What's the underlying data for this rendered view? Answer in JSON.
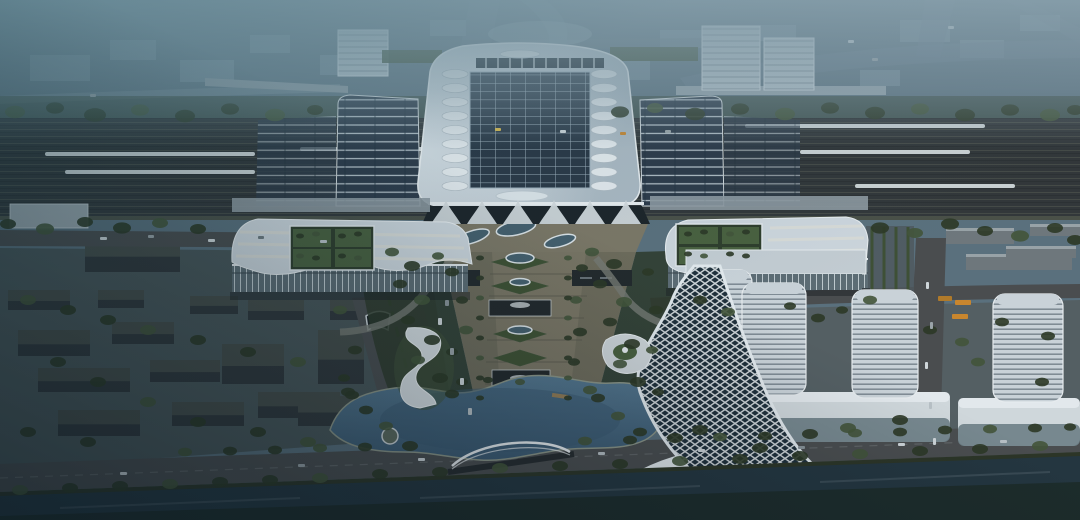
{
  "meta": {
    "title": "Aerial rendering of high-speed railway station complex at dusk",
    "description": "Bird's-eye architectural rendering: central station hall with solar roof and skylights, platform canopies over railway tracks with trains, twin wave-roof wing buildings with rooftop gardens, axial garden plaza leading to a lake with an arch bridge, a twisted lattice landmark tower, striped office towers on podiums, dark city blocks, boulevards with cars and buses, and a canal in the foreground"
  },
  "palette": {
    "base": "#5a707d",
    "sky_haze": "#8fa5b1",
    "distant_block": "#8299a6",
    "railway": "#32373a",
    "track_line": "#474c48",
    "train": "#d6dde0",
    "canopy_panel": "#2e3b4a",
    "canopy_rib": "#b6c1c9",
    "hall_roof": "#c6d0d8",
    "hall_edge": "#e7ecef",
    "solar": "#2b3947",
    "solar_frame": "#9fb0bc",
    "skylight": "#e2e8ec",
    "facade_glass": "#1d2429",
    "arch": "#d3dade",
    "wing_roof": "#ccd5dc",
    "wing_stripe": "#e6e2d2",
    "courtyard": "#2f3d2c",
    "courtyard_lawn": "#49603f",
    "wing_facade": "#5d6c74",
    "tree": "#2c3826",
    "tree_light": "#42543a",
    "lawn": "#3f5133",
    "plaza": "#6e6b5b",
    "walk": "#7c7766",
    "stair": "#5a584c",
    "road": "#4a4d4f",
    "lane": "#707476",
    "lake": "#4c6e86",
    "lake_deep": "#3a5870",
    "shore": "#8b9588",
    "canal": "#243640",
    "embankment": "#2c3527",
    "block_top": "#454c49",
    "block_side": "#30363a",
    "tower": "#c9d2d8",
    "tower_stripe": "#7c8891",
    "podium": "#cfd7db",
    "podium_glass": "#6d7f86",
    "twist": "#e2e9ed",
    "twist_glass": "#20303b",
    "bus": "#c8862e",
    "dome": "#8fa5b0",
    "overlay_teal": "#14505f",
    "vignette": "#0a1822"
  },
  "scene": {
    "station": {
      "skylight_columns": 2,
      "skylights_per_column": 9,
      "skylight_col_x": [
        455,
        604
      ],
      "skylight_y0": 74,
      "skylight_step": 14
    },
    "landmarks": [
      "main-station-hall",
      "solar-roof",
      "platform-canopies",
      "railway-tracks",
      "west-wing",
      "east-wing",
      "roof-gardens",
      "axial-garden-plaza",
      "lake",
      "arch-bridge",
      "canal",
      "twisted-tower",
      "office-towers",
      "retail-podiums",
      "city-blocks",
      "boulevard",
      "tunnel-portal"
    ],
    "trains": [
      [
        45,
        152,
        210
      ],
      [
        65,
        170,
        190
      ],
      [
        300,
        147,
        160
      ],
      [
        745,
        124,
        240
      ],
      [
        800,
        150,
        170
      ],
      [
        855,
        184,
        160
      ]
    ],
    "towers": [
      [
        706,
        270,
        46,
        95
      ],
      [
        742,
        283,
        64,
        112
      ],
      [
        852,
        290,
        66,
        108
      ],
      [
        993,
        294,
        70,
        108
      ]
    ],
    "barracks": [
      [
        946,
        228,
        68,
        16
      ],
      [
        966,
        254,
        106,
        16
      ],
      [
        1030,
        224,
        50,
        12
      ],
      [
        1006,
        246,
        70,
        12
      ]
    ],
    "west_blocks": [
      [
        18,
        330,
        72,
        26
      ],
      [
        112,
        322,
        62,
        22
      ],
      [
        38,
        368,
        92,
        24
      ],
      [
        150,
        360,
        70,
        22
      ],
      [
        222,
        344,
        62,
        40
      ],
      [
        258,
        392,
        82,
        26
      ],
      [
        172,
        402,
        72,
        24
      ],
      [
        58,
        410,
        82,
        26
      ],
      [
        248,
        300,
        56,
        20
      ],
      [
        318,
        330,
        46,
        54
      ],
      [
        298,
        396,
        62,
        30
      ],
      [
        8,
        290,
        62,
        20
      ],
      [
        98,
        290,
        46,
        18
      ],
      [
        330,
        300,
        42,
        20
      ],
      [
        85,
        238,
        95,
        34
      ],
      [
        190,
        296,
        48,
        18
      ]
    ],
    "trees": [
      [
        15,
        112,
        10
      ],
      [
        55,
        108,
        9
      ],
      [
        95,
        115,
        11
      ],
      [
        140,
        110,
        9
      ],
      [
        185,
        116,
        10
      ],
      [
        230,
        109,
        9
      ],
      [
        275,
        115,
        10
      ],
      [
        315,
        110,
        8
      ],
      [
        620,
        112,
        9
      ],
      [
        655,
        108,
        8
      ],
      [
        695,
        114,
        10
      ],
      [
        740,
        109,
        9
      ],
      [
        785,
        114,
        10
      ],
      [
        830,
        108,
        9
      ],
      [
        875,
        113,
        10
      ],
      [
        920,
        109,
        9
      ],
      [
        965,
        115,
        10
      ],
      [
        1010,
        110,
        9
      ],
      [
        1050,
        115,
        10
      ],
      [
        1075,
        110,
        8
      ],
      [
        8,
        224,
        8
      ],
      [
        45,
        229,
        9
      ],
      [
        85,
        222,
        8
      ],
      [
        122,
        228,
        9
      ],
      [
        160,
        223,
        8
      ],
      [
        198,
        229,
        8
      ],
      [
        880,
        228,
        9
      ],
      [
        915,
        233,
        8
      ],
      [
        950,
        224,
        9
      ],
      [
        985,
        231,
        8
      ],
      [
        1020,
        236,
        9
      ],
      [
        1055,
        228,
        8
      ],
      [
        1075,
        240,
        8
      ],
      [
        392,
        252,
        7
      ],
      [
        412,
        266,
        8
      ],
      [
        400,
        284,
        7
      ],
      [
        422,
        300,
        8
      ],
      [
        408,
        320,
        7
      ],
      [
        432,
        340,
        8
      ],
      [
        418,
        360,
        7
      ],
      [
        440,
        378,
        8
      ],
      [
        452,
        394,
        7
      ],
      [
        438,
        256,
        6
      ],
      [
        452,
        272,
        7
      ],
      [
        462,
        300,
        6
      ],
      [
        466,
        330,
        7
      ],
      [
        452,
        352,
        6
      ],
      [
        462,
        382,
        6
      ],
      [
        592,
        252,
        7
      ],
      [
        614,
        264,
        8
      ],
      [
        600,
        284,
        7
      ],
      [
        624,
        302,
        8
      ],
      [
        610,
        322,
        7
      ],
      [
        632,
        344,
        8
      ],
      [
        620,
        364,
        7
      ],
      [
        638,
        382,
        8
      ],
      [
        582,
        268,
        6
      ],
      [
        576,
        300,
        6
      ],
      [
        580,
        332,
        7
      ],
      [
        574,
        362,
        6
      ],
      [
        590,
        390,
        7
      ],
      [
        648,
        272,
        6
      ],
      [
        656,
        310,
        7
      ],
      [
        652,
        350,
        6
      ],
      [
        480,
        258,
        4
      ],
      [
        480,
        278,
        4
      ],
      [
        480,
        298,
        4
      ],
      [
        480,
        318,
        4
      ],
      [
        480,
        338,
        4
      ],
      [
        480,
        358,
        4
      ],
      [
        480,
        378,
        4
      ],
      [
        480,
        398,
        4
      ],
      [
        568,
        258,
        4
      ],
      [
        568,
        278,
        4
      ],
      [
        568,
        298,
        4
      ],
      [
        568,
        318,
        4
      ],
      [
        568,
        338,
        4
      ],
      [
        568,
        358,
        4
      ],
      [
        568,
        378,
        4
      ],
      [
        568,
        398,
        4
      ],
      [
        300,
        236,
        4
      ],
      [
        316,
        234,
        4
      ],
      [
        342,
        236,
        4
      ],
      [
        358,
        234,
        4
      ],
      [
        300,
        256,
        4
      ],
      [
        316,
        258,
        4
      ],
      [
        342,
        256,
        4
      ],
      [
        358,
        258,
        4
      ],
      [
        688,
        234,
        4
      ],
      [
        704,
        232,
        4
      ],
      [
        730,
        234,
        4
      ],
      [
        746,
        232,
        4
      ],
      [
        688,
        254,
        4
      ],
      [
        704,
        256,
        4
      ],
      [
        730,
        254,
        4
      ],
      [
        746,
        256,
        4
      ],
      [
        185,
        452,
        7
      ],
      [
        230,
        451,
        7
      ],
      [
        275,
        450,
        7
      ],
      [
        320,
        448,
        7
      ],
      [
        365,
        447,
        7
      ],
      [
        410,
        446,
        8
      ],
      [
        585,
        441,
        7
      ],
      [
        630,
        440,
        7
      ],
      [
        675,
        438,
        8
      ],
      [
        720,
        437,
        7
      ],
      [
        765,
        436,
        7
      ],
      [
        810,
        434,
        8
      ],
      [
        855,
        433,
        7
      ],
      [
        900,
        432,
        7
      ],
      [
        945,
        430,
        7
      ],
      [
        990,
        429,
        7
      ],
      [
        1035,
        428,
        7
      ],
      [
        1070,
        427,
        6
      ],
      [
        20,
        490,
        8
      ],
      [
        70,
        488,
        8
      ],
      [
        120,
        486,
        8
      ],
      [
        170,
        484,
        8
      ],
      [
        220,
        482,
        8
      ],
      [
        270,
        480,
        8
      ],
      [
        320,
        478,
        8
      ],
      [
        380,
        474,
        8
      ],
      [
        440,
        472,
        8
      ],
      [
        500,
        468,
        8
      ],
      [
        560,
        466,
        8
      ],
      [
        620,
        464,
        8
      ],
      [
        680,
        461,
        8
      ],
      [
        740,
        459,
        8
      ],
      [
        800,
        456,
        8
      ],
      [
        860,
        454,
        8
      ],
      [
        920,
        451,
        8
      ],
      [
        980,
        449,
        8
      ],
      [
        1040,
        446,
        8
      ],
      [
        348,
        392,
        7
      ],
      [
        366,
        410,
        7
      ],
      [
        386,
        426,
        7
      ],
      [
        344,
        378,
        6
      ],
      [
        598,
        398,
        7
      ],
      [
        618,
        416,
        7
      ],
      [
        640,
        432,
        7
      ],
      [
        658,
        392,
        6
      ],
      [
        520,
        382,
        5
      ],
      [
        488,
        380,
        5
      ],
      [
        700,
        300,
        7
      ],
      [
        728,
        312,
        7
      ],
      [
        818,
        318,
        7
      ],
      [
        842,
        310,
        6
      ],
      [
        870,
        300,
        7
      ],
      [
        790,
        306,
        6
      ],
      [
        930,
        330,
        7
      ],
      [
        962,
        342,
        7
      ],
      [
        1002,
        322,
        7
      ],
      [
        1048,
        336,
        7
      ],
      [
        978,
        362,
        7
      ],
      [
        1042,
        382,
        7
      ],
      [
        900,
        420,
        8
      ],
      [
        848,
        428,
        8
      ],
      [
        700,
        430,
        8
      ],
      [
        760,
        448,
        8
      ],
      [
        28,
        300,
        8
      ],
      [
        68,
        310,
        8
      ],
      [
        108,
        320,
        8
      ],
      [
        148,
        330,
        8
      ],
      [
        198,
        340,
        8
      ],
      [
        248,
        352,
        8
      ],
      [
        298,
        362,
        8
      ],
      [
        58,
        362,
        8
      ],
      [
        98,
        382,
        8
      ],
      [
        148,
        402,
        8
      ],
      [
        198,
        422,
        8
      ],
      [
        258,
        432,
        8
      ],
      [
        308,
        442,
        8
      ],
      [
        28,
        432,
        8
      ],
      [
        88,
        442,
        8
      ],
      [
        340,
        310,
        7
      ],
      [
        355,
        350,
        7
      ],
      [
        352,
        395,
        7
      ]
    ],
    "vehicles": [
      [
        100,
        237,
        7,
        3,
        "#cfd6da"
      ],
      [
        148,
        235,
        6,
        3,
        "#9aa3a8"
      ],
      [
        208,
        239,
        7,
        3,
        "#cfd6da"
      ],
      [
        258,
        236,
        6,
        3,
        "#6e7a80"
      ],
      [
        320,
        240,
        7,
        3,
        "#b7c0c5"
      ],
      [
        438,
        318,
        4,
        7,
        "#cfd6da"
      ],
      [
        450,
        348,
        4,
        7,
        "#9aa3a8"
      ],
      [
        460,
        378,
        4,
        7,
        "#cfd6da"
      ],
      [
        468,
        408,
        4,
        7,
        "#b7c0c5"
      ],
      [
        445,
        300,
        4,
        6,
        "#8a9499"
      ],
      [
        120,
        472,
        7,
        3,
        "#cfd6da"
      ],
      [
        298,
        464,
        7,
        3,
        "#9aa3a8"
      ],
      [
        418,
        458,
        7,
        3,
        "#cfd6da"
      ],
      [
        598,
        452,
        7,
        3,
        "#b7c0c5"
      ],
      [
        698,
        449,
        7,
        3,
        "#cfd6da"
      ],
      [
        798,
        446,
        7,
        3,
        "#8a9499"
      ],
      [
        898,
        443,
        7,
        3,
        "#cfd6da"
      ],
      [
        1000,
        440,
        7,
        3,
        "#b7c0c5"
      ],
      [
        926,
        282,
        3,
        7,
        "#cfd6da"
      ],
      [
        930,
        322,
        3,
        7,
        "#9aa3a8"
      ],
      [
        925,
        362,
        3,
        7,
        "#cfd6da"
      ],
      [
        929,
        402,
        3,
        7,
        "#b7c0c5"
      ],
      [
        933,
        438,
        3,
        7,
        "#cfd6da"
      ],
      [
        955,
        300,
        16,
        5,
        "#c8862e"
      ],
      [
        952,
        314,
        16,
        5,
        "#c8862e"
      ],
      [
        938,
        296,
        14,
        5,
        "#b07a2a"
      ],
      [
        848,
        40,
        6,
        3,
        "#cfd6da"
      ],
      [
        872,
        58,
        6,
        3,
        "#9aa3a8"
      ],
      [
        948,
        26,
        6,
        3,
        "#cfd6da"
      ],
      [
        495,
        128,
        6,
        3,
        "#d8b84a"
      ],
      [
        560,
        130,
        6,
        3,
        "#cfd6da"
      ],
      [
        620,
        132,
        6,
        3,
        "#c8862e"
      ],
      [
        665,
        130,
        6,
        3,
        "#9aa3a8"
      ],
      [
        90,
        94,
        6,
        3,
        "#9aa3a8"
      ]
    ]
  }
}
